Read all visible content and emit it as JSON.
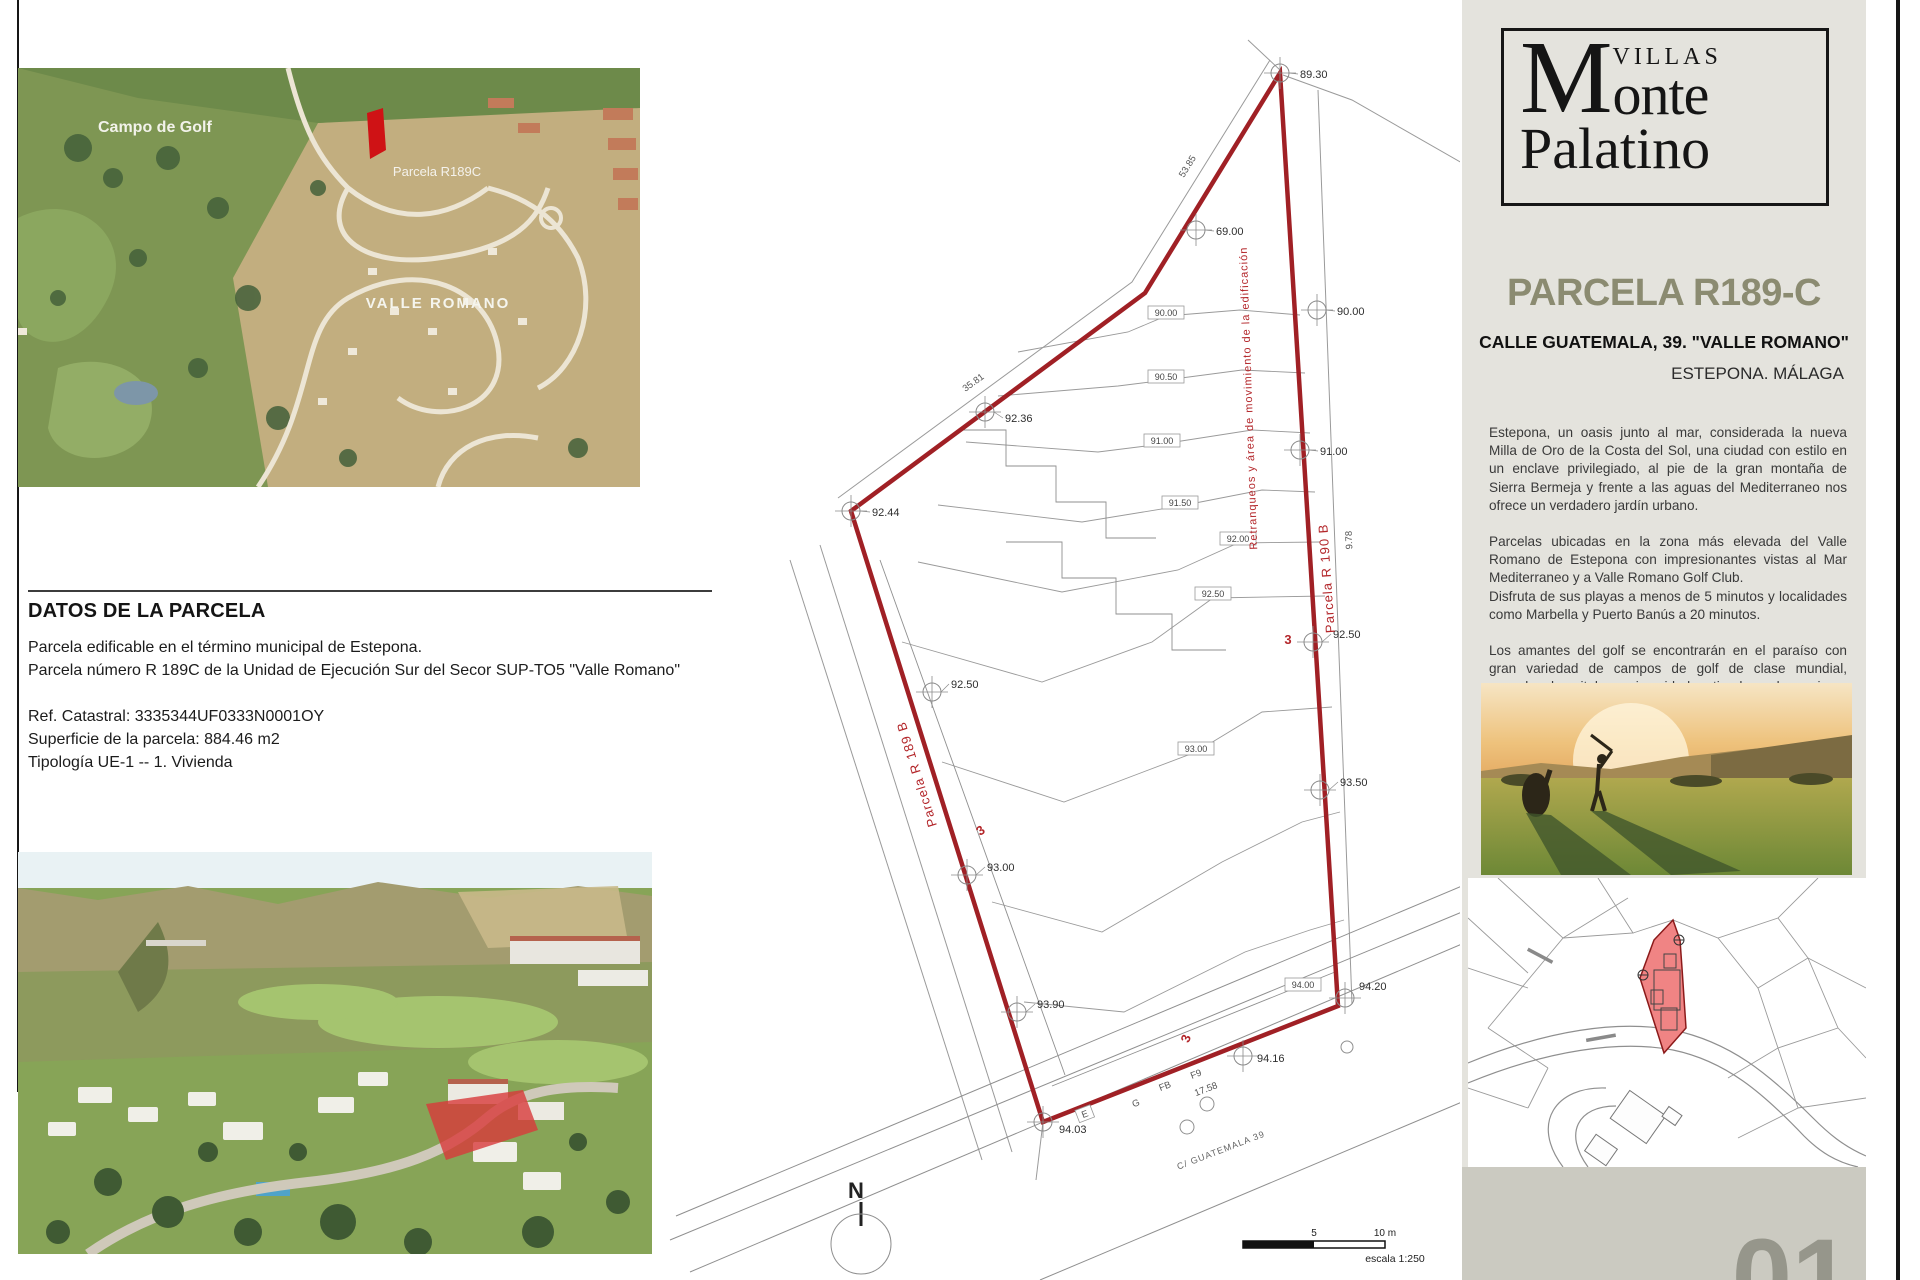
{
  "left_column": {
    "satellite_map": {
      "label_golf": "Campo de Golf",
      "label_parcel": "Parcela R189C",
      "label_area": "VALLE ROMANO",
      "highlight_color": "#cf1215"
    },
    "datos": {
      "title": "DATOS DE LA PARCELA",
      "line1": "Parcela edificable en el término municipal de Estepona.",
      "line2": "Parcela número R 189C de la Unidad de Ejecución Sur del Secor SUP-TO5 \"Valle Romano\"",
      "line3": "Ref. Catastral: 3335344UF0333N0001OY",
      "line4": "Superficie de la parcela: 884.46 m2",
      "line5": "Tipología UE-1 -- 1. Vivienda"
    }
  },
  "plan": {
    "boundary_color": "#a02025",
    "spot_elevations": [
      {
        "label": "89.30",
        "mx": 1280,
        "my": 73,
        "lx": 1300,
        "ly": 78
      },
      {
        "label": "69.00",
        "mx": 1196,
        "my": 230,
        "lx": 1216,
        "ly": 235
      },
      {
        "label": "90.00",
        "mx": 1317,
        "my": 310,
        "lx": 1337,
        "ly": 315
      },
      {
        "label": "91.00",
        "mx": 1300,
        "my": 450,
        "lx": 1320,
        "ly": 455
      },
      {
        "label": "92.36",
        "mx": 985,
        "my": 412,
        "lx": 1005,
        "ly": 422
      },
      {
        "label": "92.44",
        "mx": 851,
        "my": 511,
        "lx": 872,
        "ly": 516
      },
      {
        "label": "92.50",
        "mx": 932,
        "my": 692,
        "lx": 951,
        "ly": 688
      },
      {
        "label": "92.50",
        "mx": 1313,
        "my": 642,
        "lx": 1333,
        "ly": 638
      },
      {
        "label": "93.00",
        "mx": 967,
        "my": 875,
        "lx": 987,
        "ly": 871
      },
      {
        "label": "93.50",
        "mx": 1320,
        "my": 790,
        "lx": 1340,
        "ly": 786
      },
      {
        "label": "93.90",
        "mx": 1017,
        "my": 1012,
        "lx": 1037,
        "ly": 1008
      },
      {
        "label": "94.20",
        "mx": 1345,
        "my": 998,
        "lx": 1359,
        "ly": 990
      },
      {
        "label": "94.16",
        "mx": 1243,
        "my": 1056,
        "lx": 1257,
        "ly": 1062
      },
      {
        "label": "94.03",
        "mx": 1043,
        "my": 1122,
        "lx": 1059,
        "ly": 1133
      }
    ],
    "contour_labels": [
      {
        "label": "90.00",
        "x": 1166,
        "y": 316
      },
      {
        "label": "90.50",
        "x": 1166,
        "y": 380
      },
      {
        "label": "91.00",
        "x": 1162,
        "y": 444
      },
      {
        "label": "91.50",
        "x": 1180,
        "y": 506
      },
      {
        "label": "92.00",
        "x": 1238,
        "y": 542
      },
      {
        "label": "92.50",
        "x": 1213,
        "y": 597
      },
      {
        "label": "93.00",
        "x": 1196,
        "y": 752
      },
      {
        "label": "94.00",
        "x": 1303,
        "y": 988
      }
    ],
    "dimension_labels": [
      {
        "label": "53.85",
        "x": 1190,
        "y": 168,
        "rot": -58
      },
      {
        "label": "35.81",
        "x": 975,
        "y": 385,
        "rot": -36
      },
      {
        "label": "9.78",
        "x": 1352,
        "y": 540,
        "rot": -92
      },
      {
        "label": "17.58",
        "x": 1207,
        "y": 1092,
        "rot": -21
      },
      {
        "label": "3",
        "x": 1288,
        "y": 644,
        "rot": 0,
        "red": true
      },
      {
        "label": "3",
        "x": 983,
        "y": 834,
        "rot": -36,
        "red": true
      },
      {
        "label": "3",
        "x": 1190,
        "y": 1040,
        "rot": -70,
        "red": true
      },
      {
        "label": "E",
        "x": 1086,
        "y": 1117,
        "rot": -21,
        "box": true
      },
      {
        "label": "G",
        "x": 1137,
        "y": 1106,
        "rot": -21
      },
      {
        "label": "FB",
        "x": 1166,
        "y": 1089,
        "rot": -21
      },
      {
        "label": "F9",
        "x": 1197,
        "y": 1077,
        "rot": -21
      }
    ],
    "area_labels": [
      {
        "label": "Retranqueos y área de movimiento de la edificación",
        "x": 1252,
        "y": 398,
        "rot": -92,
        "size": 11
      },
      {
        "label": "Parcela R 190 B",
        "x": 1331,
        "y": 578,
        "rot": -94,
        "size": 13
      },
      {
        "label": "Parcela R 189 B",
        "x": 921,
        "y": 773,
        "rot": -107,
        "size": 13
      }
    ],
    "street_label": {
      "label": "C/ GUATEMALA 39",
      "x": 1222,
      "y": 1153,
      "rot": -21
    },
    "north_label": "N",
    "scale_bar": {
      "tick_mid": "5",
      "tick_end": "10 m",
      "caption": "escala 1:250"
    }
  },
  "sidebar": {
    "logo": {
      "villas": "VILLAS",
      "monte_initial": "M",
      "monte_rest": "onte",
      "palatino": "Palatino"
    },
    "title": "PARCELA R189-C",
    "subtitle": "CALLE GUATEMALA, 39. \"VALLE ROMANO\"",
    "location": "ESTEPONA. MÁLAGA",
    "paragraphs": [
      "Estepona, un oasis junto al mar, considerada la nueva Milla de Oro de la Costa del Sol, una ciudad con estilo en un enclave privilegiado, al pie de la gran montaña de Sierra Bermeja y frente a las aguas del Mediterraneo nos ofrece un verdadero jardín urbano.",
      "Parcelas ubicadas en la zona más elevada del Valle Romano de Estepona con impresionantes vistas al Mar Mediterraneo y a Valle Romano Golf Club.",
      "Disfruta de sus playas a menos de 5 minutos y localidades como Marbella y Puerto Banús a 20 minutos.",
      "Los amantes del golf se encontrarán en el paraíso con gran variedad de campos de golf de clase mundial, escuelas, hospitales, universidades, tiendas, y las mejores ofertas gastronómicas con restaurantes de reconocido mérito."
    ],
    "page_number": "01"
  }
}
